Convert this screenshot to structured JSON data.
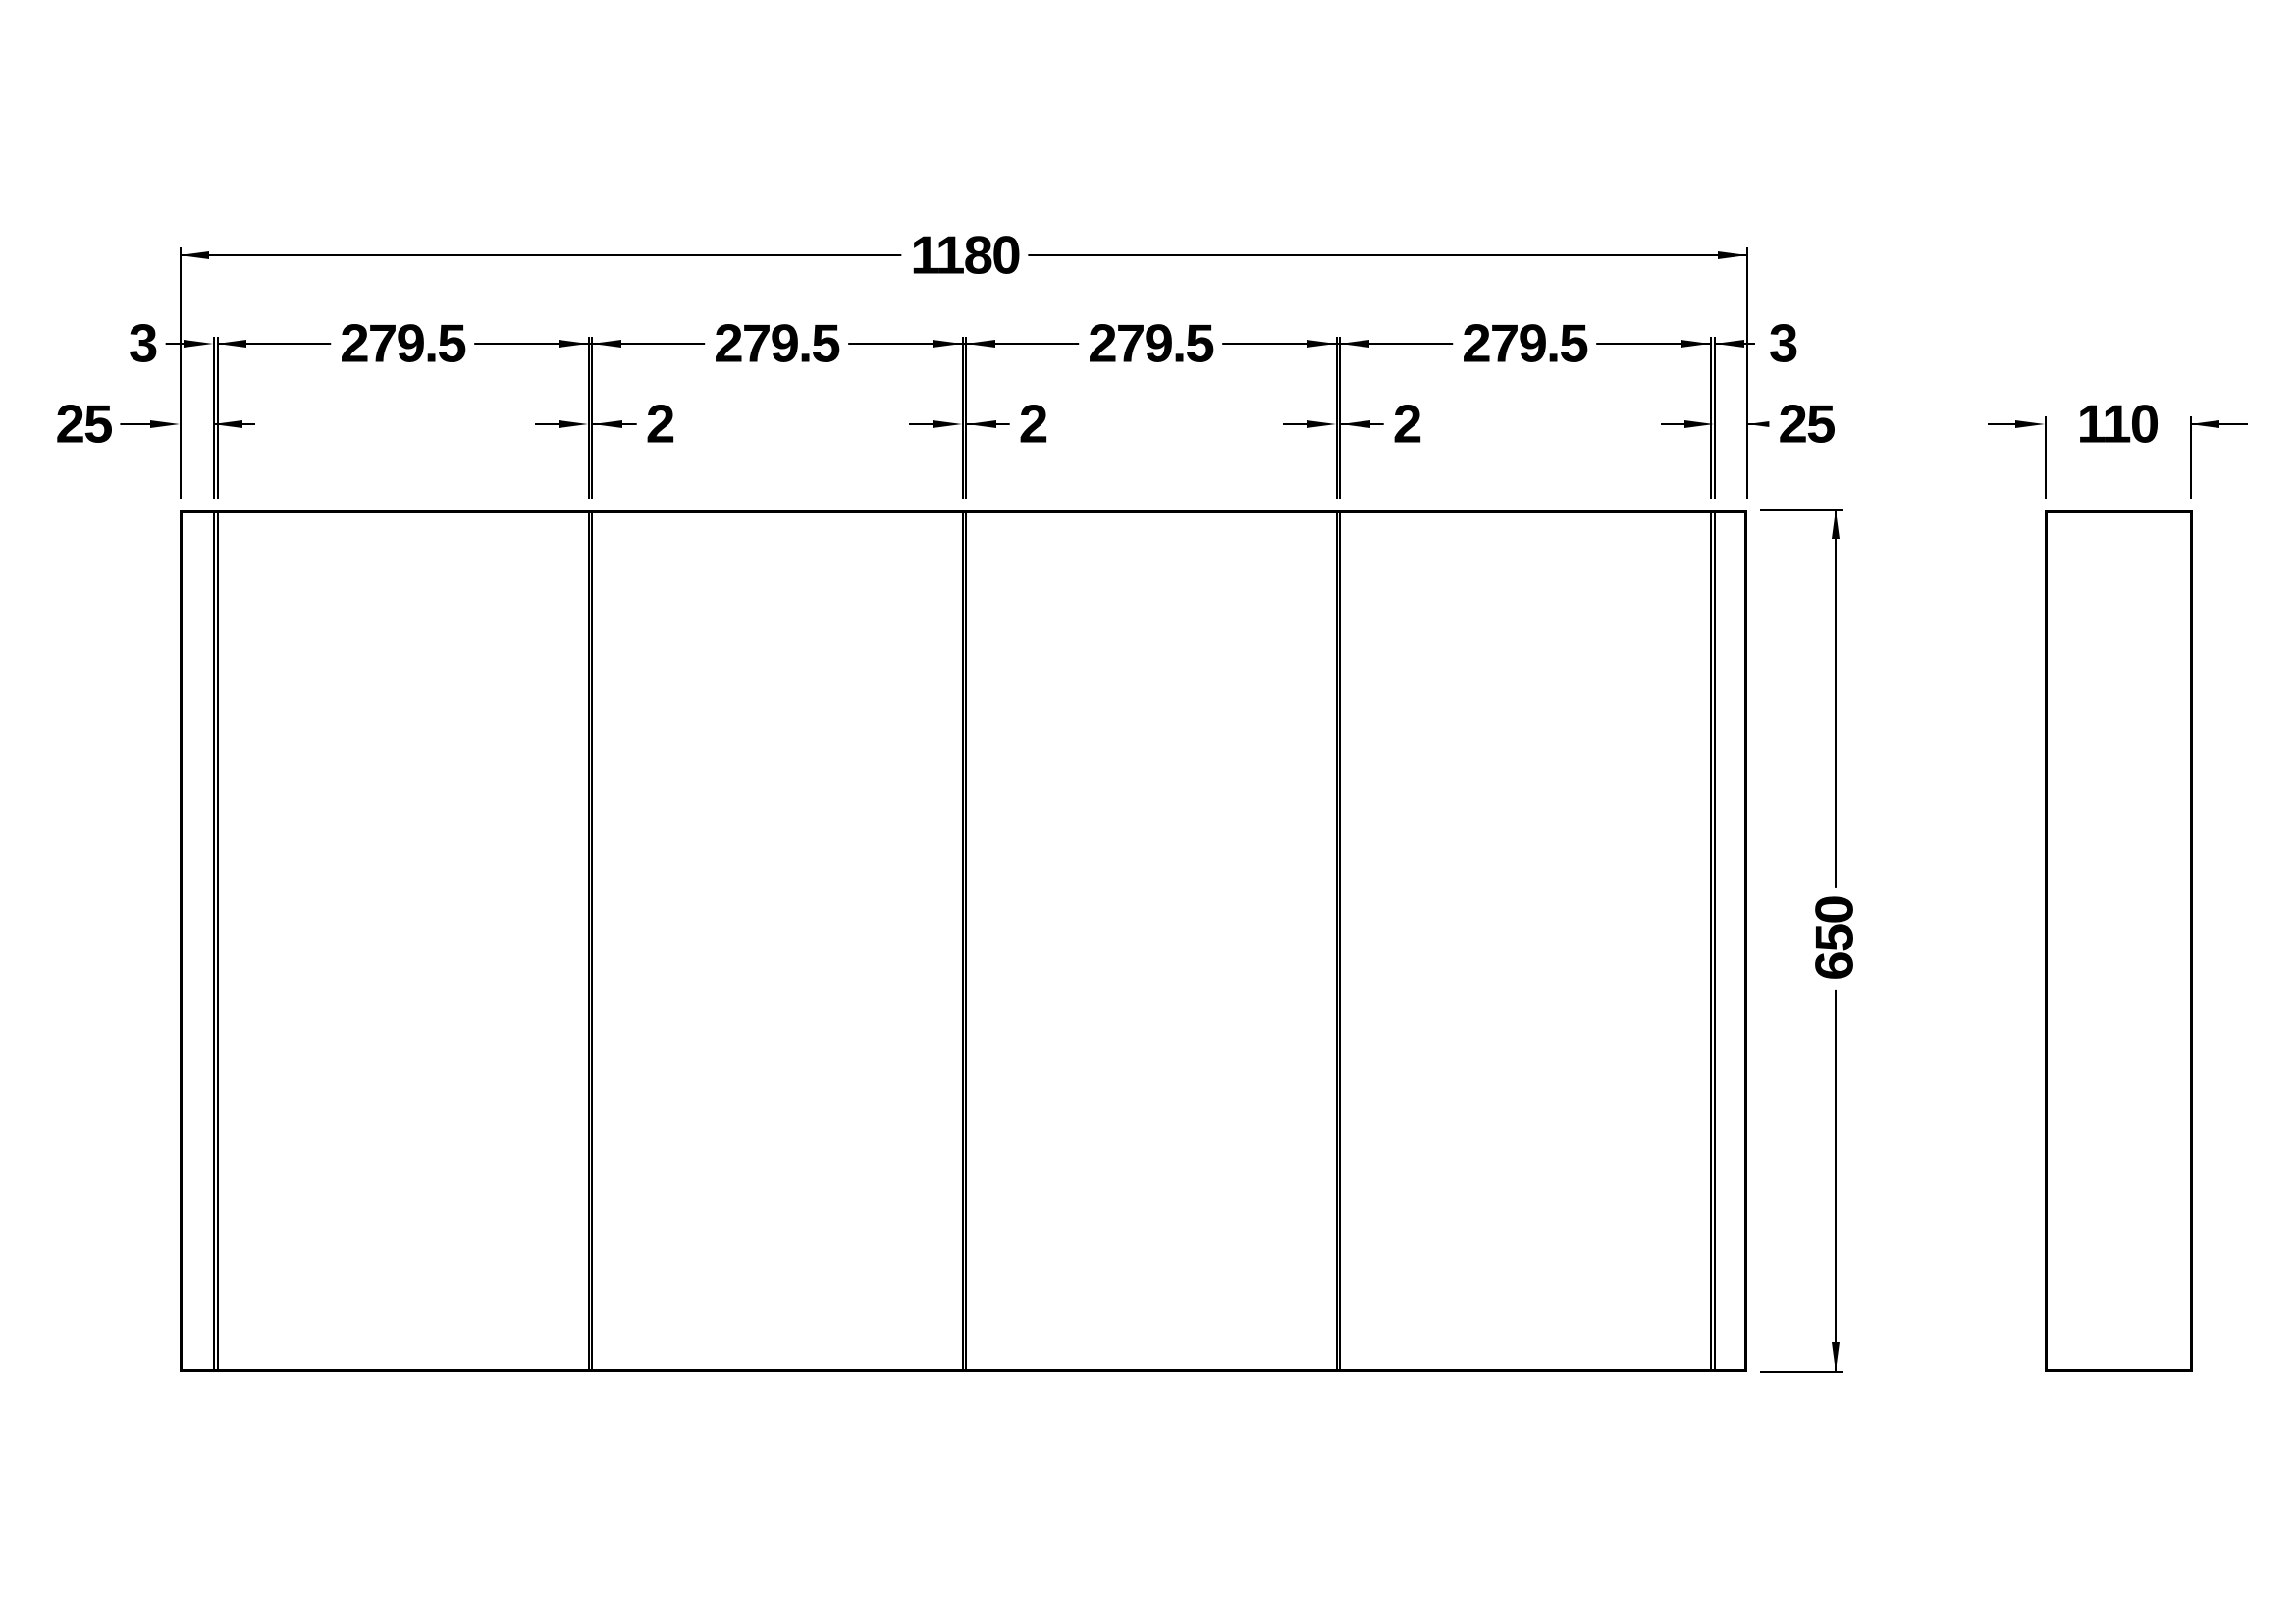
{
  "drawing": {
    "type": "orthographic-dimension-drawing",
    "background": "#ffffff",
    "line_color": "#000000"
  },
  "dimensions": {
    "total_width": "1180",
    "height": "650",
    "depth": "110",
    "top_chain": [
      "3",
      "279.5",
      "279.5",
      "279.5",
      "279.5",
      "3"
    ],
    "bottom_chain": [
      "25",
      "2",
      "2",
      "2",
      "25"
    ]
  }
}
